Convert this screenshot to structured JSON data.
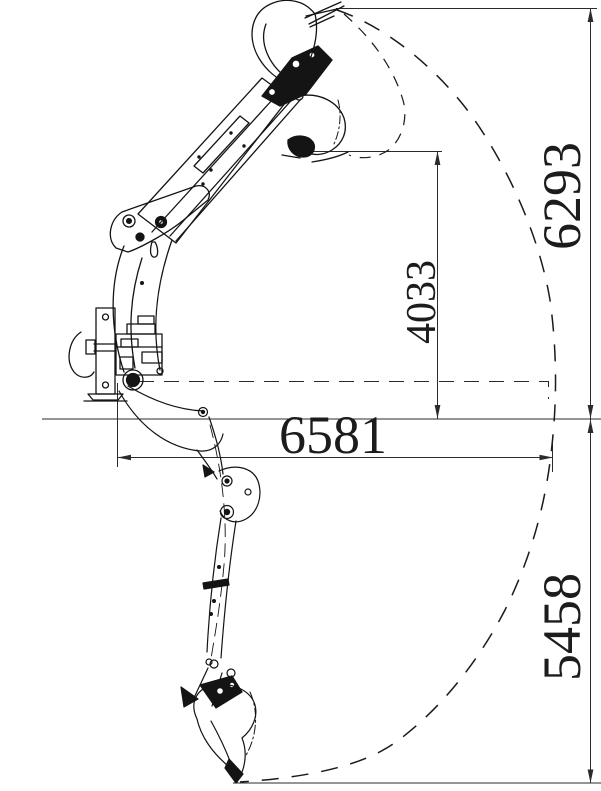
{
  "diagram": {
    "type": "technical-line-drawing",
    "subject": "backhoe-excavator-working-range",
    "background": "#ffffff",
    "ink": "#1a1a1a",
    "dimensions": {
      "max_height": "6293",
      "dump_height": "4033",
      "max_reach": "6581",
      "dig_depth": "5458"
    }
  }
}
